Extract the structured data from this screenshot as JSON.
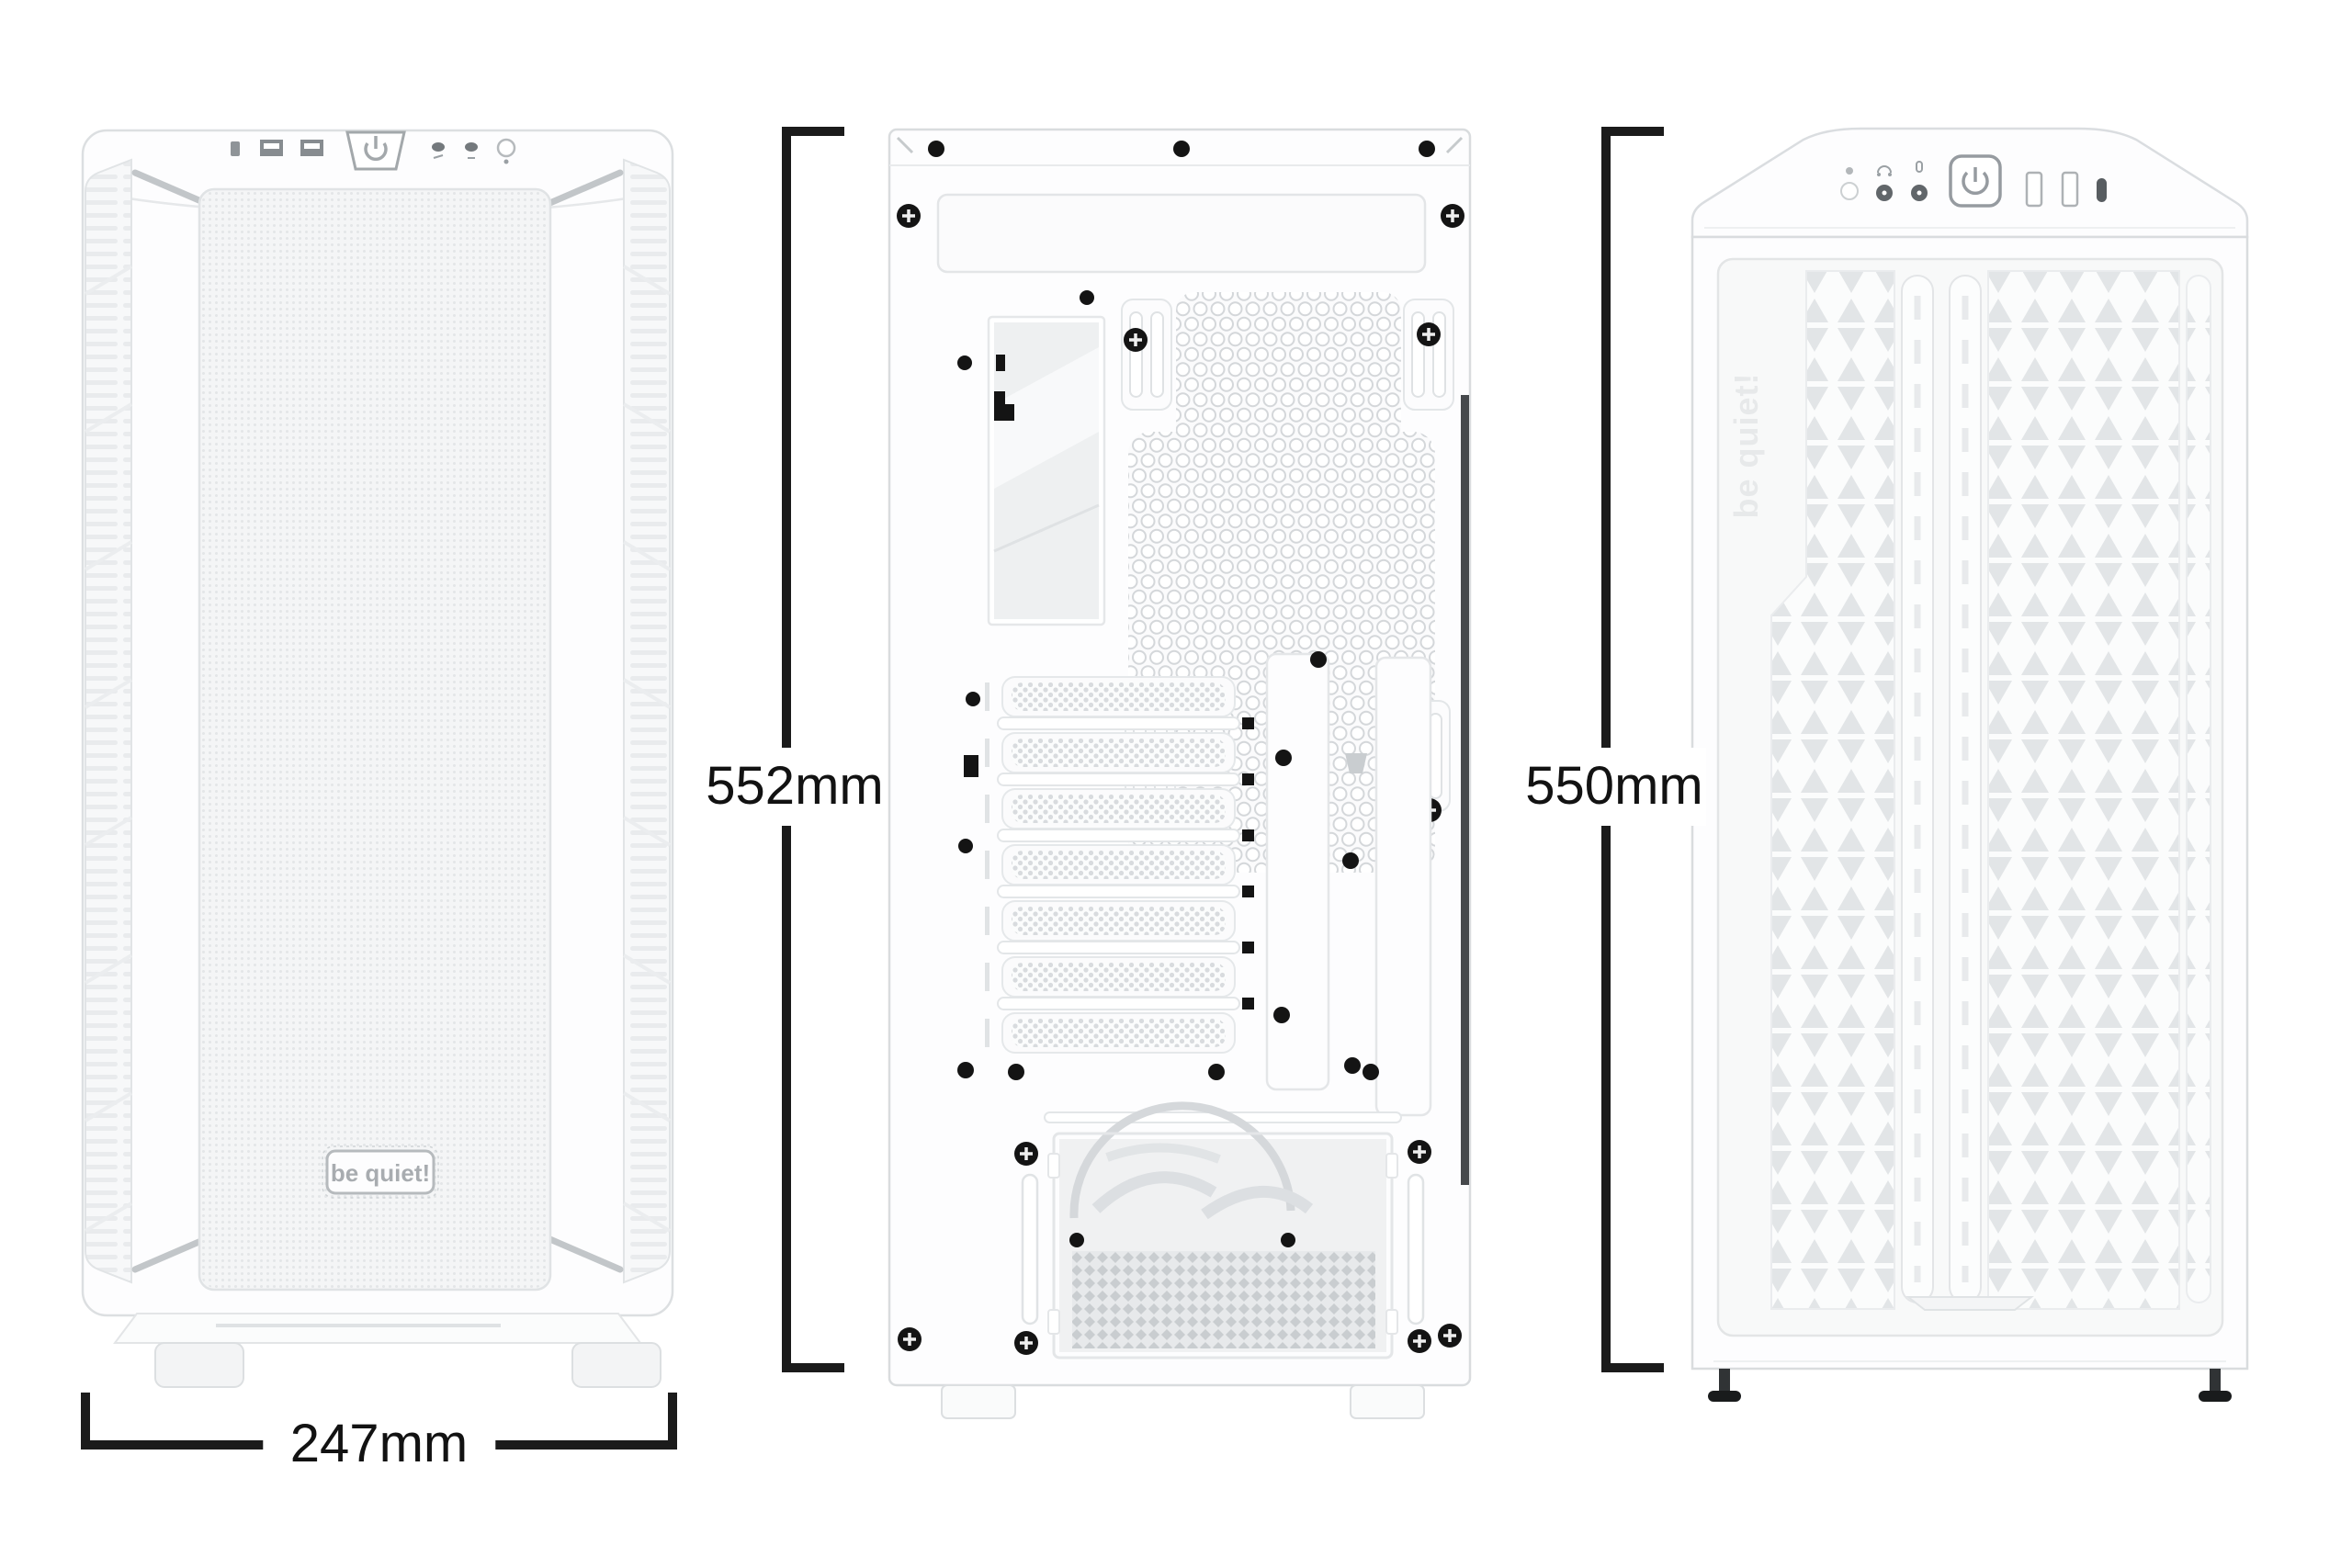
{
  "diagram": {
    "type": "product-dimension-diagram",
    "brand": "be quiet!"
  },
  "dimensions": {
    "front_width": "247mm",
    "rear_height": "552mm",
    "front_height": "550mm"
  },
  "front_view": {
    "badge_text": "be quiet!",
    "io_ports": [
      "audio-jack",
      "usb-a",
      "usb-a",
      "power-button",
      "led-button",
      "led-button",
      "reset-button"
    ]
  },
  "rear_view": {
    "pci_slot_count": 7
  },
  "front_mesh_view": {
    "embossed_text": "be quiet!",
    "io_ports": [
      "power-led",
      "headphone-jack",
      "mic-jack",
      "power-button",
      "usb-a",
      "usb-a",
      "usb-c"
    ]
  },
  "colors": {
    "background": "#ffffff",
    "case_body": "#fdfdfe",
    "outline": "#d9dcde",
    "mesh": "#e4e7e9",
    "screw": "#141414",
    "dimension_line": "#1b1b1b",
    "label_text": "#121212"
  }
}
